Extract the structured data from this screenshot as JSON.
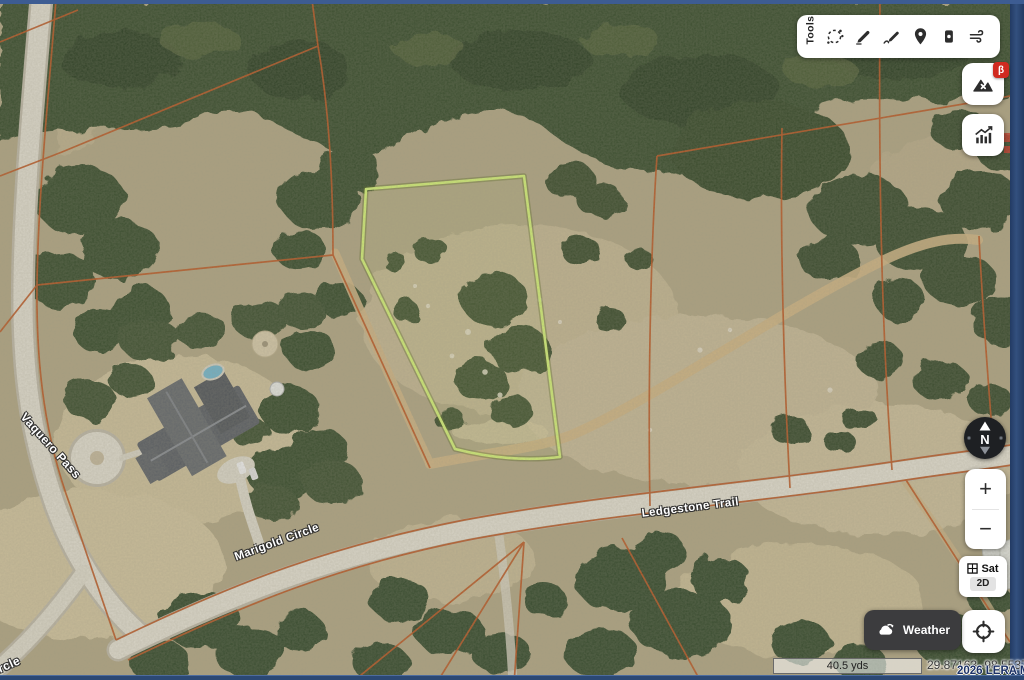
{
  "map": {
    "street_labels": [
      {
        "id": "vaquero-pass",
        "text": "Vaquero Pass"
      },
      {
        "id": "marigold-circle",
        "text": "Marigold Circle"
      },
      {
        "id": "ledgestone-trail",
        "text": "Ledgestone Trail"
      },
      {
        "id": "circle-fragment",
        "text": "Circle"
      }
    ],
    "colors": {
      "highlighted_parcel": "#cdea72",
      "parcel_lines": "#b5521f",
      "road": "#dbd7ca",
      "frame_blue": "#2e4c7c"
    }
  },
  "toolbar": {
    "label": "Tools",
    "tools": [
      {
        "name": "lasso-select",
        "icon": "lasso-select-icon"
      },
      {
        "name": "highlighter",
        "icon": "highlighter-icon"
      },
      {
        "name": "draw-path",
        "icon": "draw-path-icon"
      },
      {
        "name": "map-pin",
        "icon": "map-pin-icon"
      },
      {
        "name": "label-tag",
        "icon": "label-tag-icon"
      },
      {
        "name": "wind",
        "icon": "wind-icon"
      }
    ]
  },
  "side_controls": {
    "layers_button": {
      "icon": "terrain-layers-icon",
      "badge": "β",
      "badge_color": "#d02b20"
    },
    "stats_button": {
      "icon": "stats-chart-icon"
    },
    "compass": {
      "north_label": "N"
    },
    "zoom_control": {
      "zoom_in": "+",
      "zoom_out": "−"
    },
    "basemap_toggle": {
      "icon": "satellite-grid-icon",
      "sat_label": "Sat",
      "mode_label": "2D"
    },
    "locate_button": {
      "icon": "crosshair-icon"
    }
  },
  "weather_button": {
    "label": "Weather",
    "icon": "cloud-refresh-icon"
  },
  "status_bar": {
    "scale_label": "40.5 yds",
    "coordinates": "29.87163 -98.55377",
    "watermark": "2026 LERA MLS"
  }
}
